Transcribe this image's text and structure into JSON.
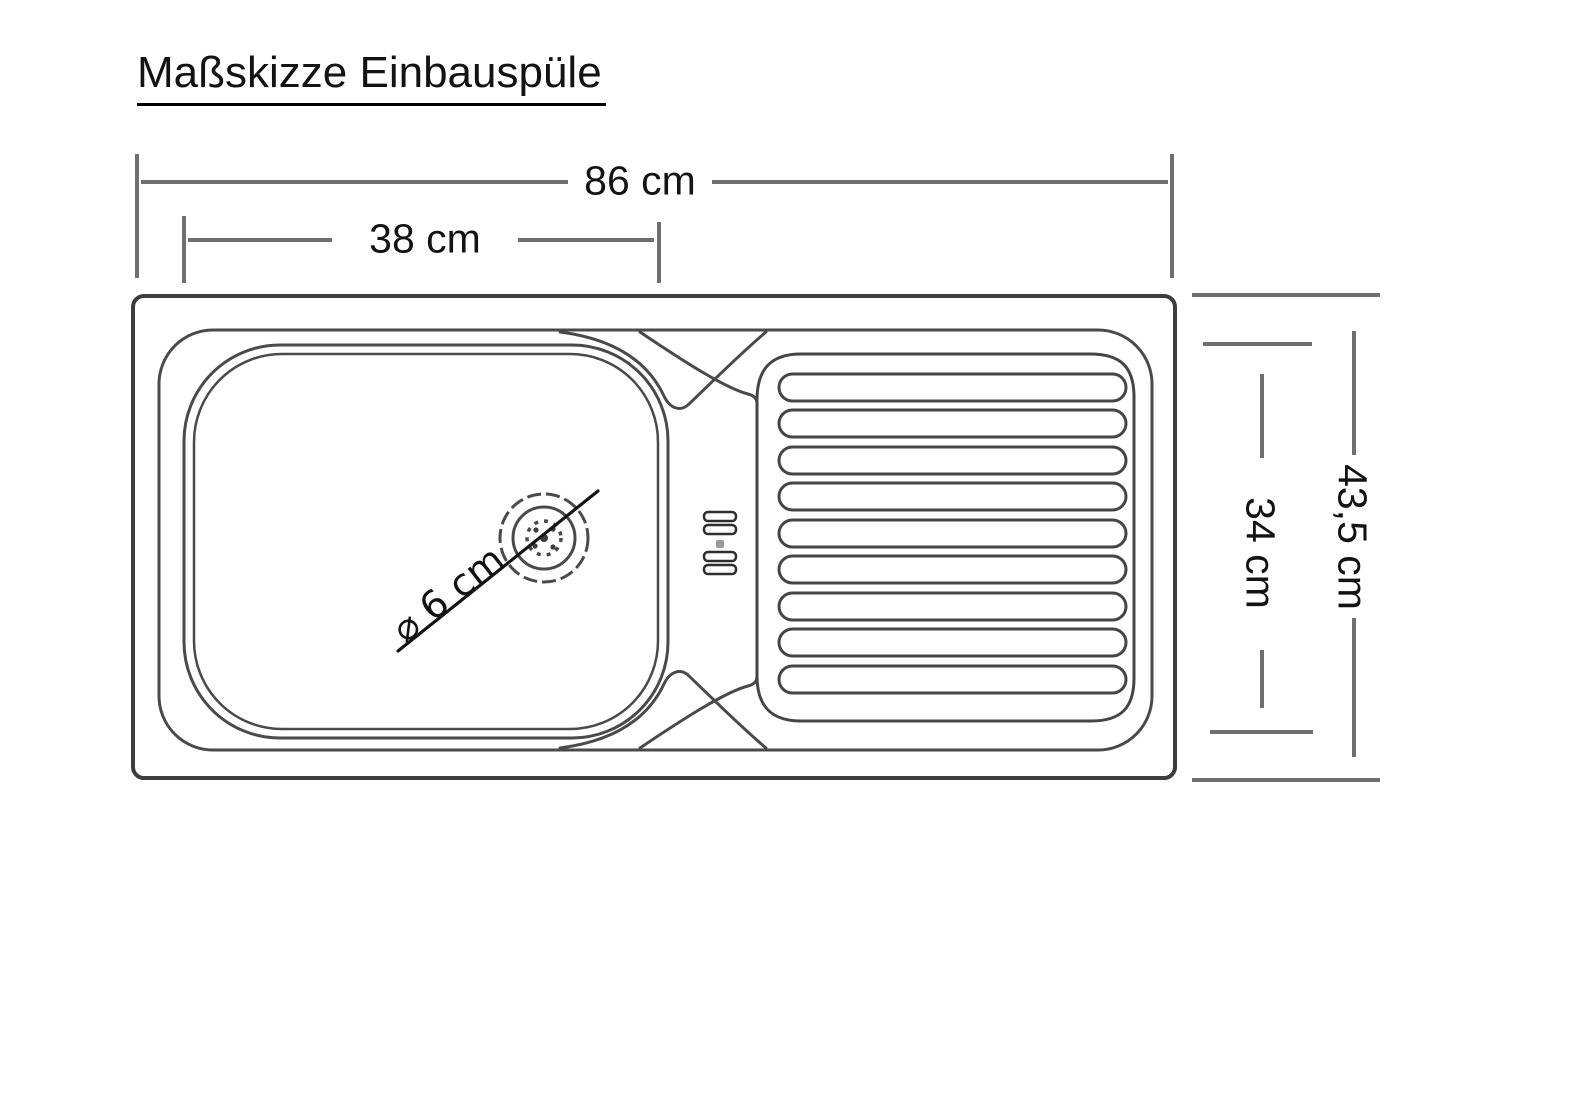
{
  "title": {
    "text": "Maßskizze Einbauspüle"
  },
  "figure": {
    "kind": "technical-dimension-sketch",
    "subject": "built-in sink top view with bowl, drain, tap holes and ribbed drainboard"
  },
  "dimensions": {
    "total_width": {
      "label": "86 cm",
      "value_cm": 86
    },
    "bowl_width": {
      "label": "38 cm",
      "value_cm": 38
    },
    "total_depth": {
      "label": "43,5 cm",
      "value_cm": 43.5
    },
    "inner_depth": {
      "label": "34 cm",
      "value_cm": 34
    },
    "drain_diameter": {
      "label": "⌀ 6 cm",
      "value_cm": 6
    }
  },
  "colors": {
    "background": "#ffffff",
    "outline": "#3d3d3d",
    "inner_line": "#4a4a4a",
    "dimension_line": "#6f6f6f",
    "text": "#131313"
  }
}
